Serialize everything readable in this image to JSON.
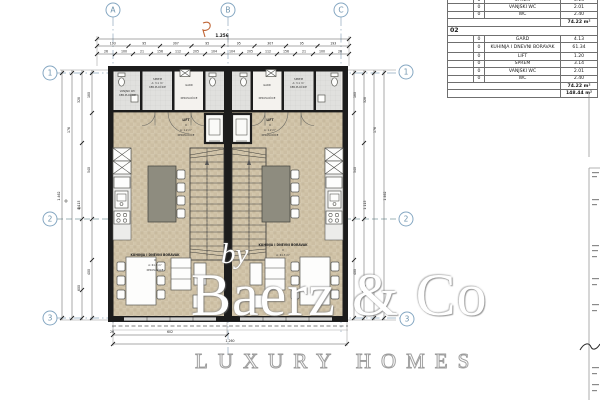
{
  "colors": {
    "floor": "#d2c5aa",
    "tile": "#e0e0de",
    "wall": "#1c1c1c",
    "island": "#8e8c7f",
    "grid_accent": "#85a7c2",
    "revision_mark": "#bf6434"
  },
  "watermark": {
    "prefix": "by",
    "brand": "Baerz & Co",
    "tagline": "LUXURY HOMES"
  },
  "grid": {
    "cols": [
      "A",
      "B",
      "C"
    ],
    "rows": [
      "1",
      "2",
      "3"
    ]
  },
  "room_labels": {
    "vanjski_wc": {
      "name": "VANJSKI WC",
      "area": "A: 2.0 m²",
      "floor": "KER.PLOČICE"
    },
    "sprem": {
      "name": "SPREM",
      "area": "A: 3.1 m²",
      "floor": "KER.PLOČICE"
    },
    "gard": {
      "name": "GARD",
      "area": "A: 4.1 m²",
      "floor": "KER.PLOČICE"
    },
    "wc": {
      "name": "WC",
      "area": "A: 2.4 m²",
      "floor": "KER.PLOČICE"
    },
    "lift": {
      "name": "LIFT",
      "num": "0",
      "area": "A: 1.2 m²",
      "floor": "KER.PLOČICE"
    },
    "kitchen": {
      "name": "KUHINJA I DNEVNI BORAVAK",
      "num": "0",
      "area": "A: 61.3 m²",
      "floor": "KER.PLOČICE"
    }
  },
  "dims": {
    "top_total": "1.256",
    "top_row1": [
      "193",
      "95",
      "307",
      "95",
      "95",
      "307",
      "95",
      "193"
    ],
    "top_row2": [
      "26",
      "100",
      "21",
      "156",
      "112",
      "205",
      "104",
      "104",
      "205",
      "112",
      "156",
      "21",
      "100",
      "26"
    ],
    "side_col": [
      "180",
      "328",
      "176",
      "540",
      "1.115",
      "600",
      "400",
      "1.462"
    ],
    "bottom_left_tick": "26",
    "bottom_half": "602",
    "bottom_total": "1.260"
  },
  "area_table": {
    "clipped_rows": [
      {
        "num": "0",
        "name": "SPREM",
        "value": "3.14"
      },
      {
        "num": "0",
        "name": "VANJSKI WC",
        "value": "2.01"
      },
      {
        "num": "0",
        "name": "WC",
        "value": "2.40"
      }
    ],
    "section01_total": "74.22 m²",
    "section02": {
      "id": "02",
      "rows": [
        {
          "num": "0",
          "name": "GARD",
          "value": "4.13"
        },
        {
          "num": "0",
          "name": "KUHINJA I DNEVNI BORAVAK",
          "value": "61.34"
        },
        {
          "num": "0",
          "name": "LIFT",
          "value": "1.20"
        },
        {
          "num": "0",
          "name": "SPREM",
          "value": "3.14"
        },
        {
          "num": "0",
          "name": "VANJSKI WC",
          "value": "2.01"
        },
        {
          "num": "0",
          "name": "WC",
          "value": "2.40"
        }
      ],
      "total": "74.22 m²"
    },
    "grand_total": "148.44 m²"
  }
}
